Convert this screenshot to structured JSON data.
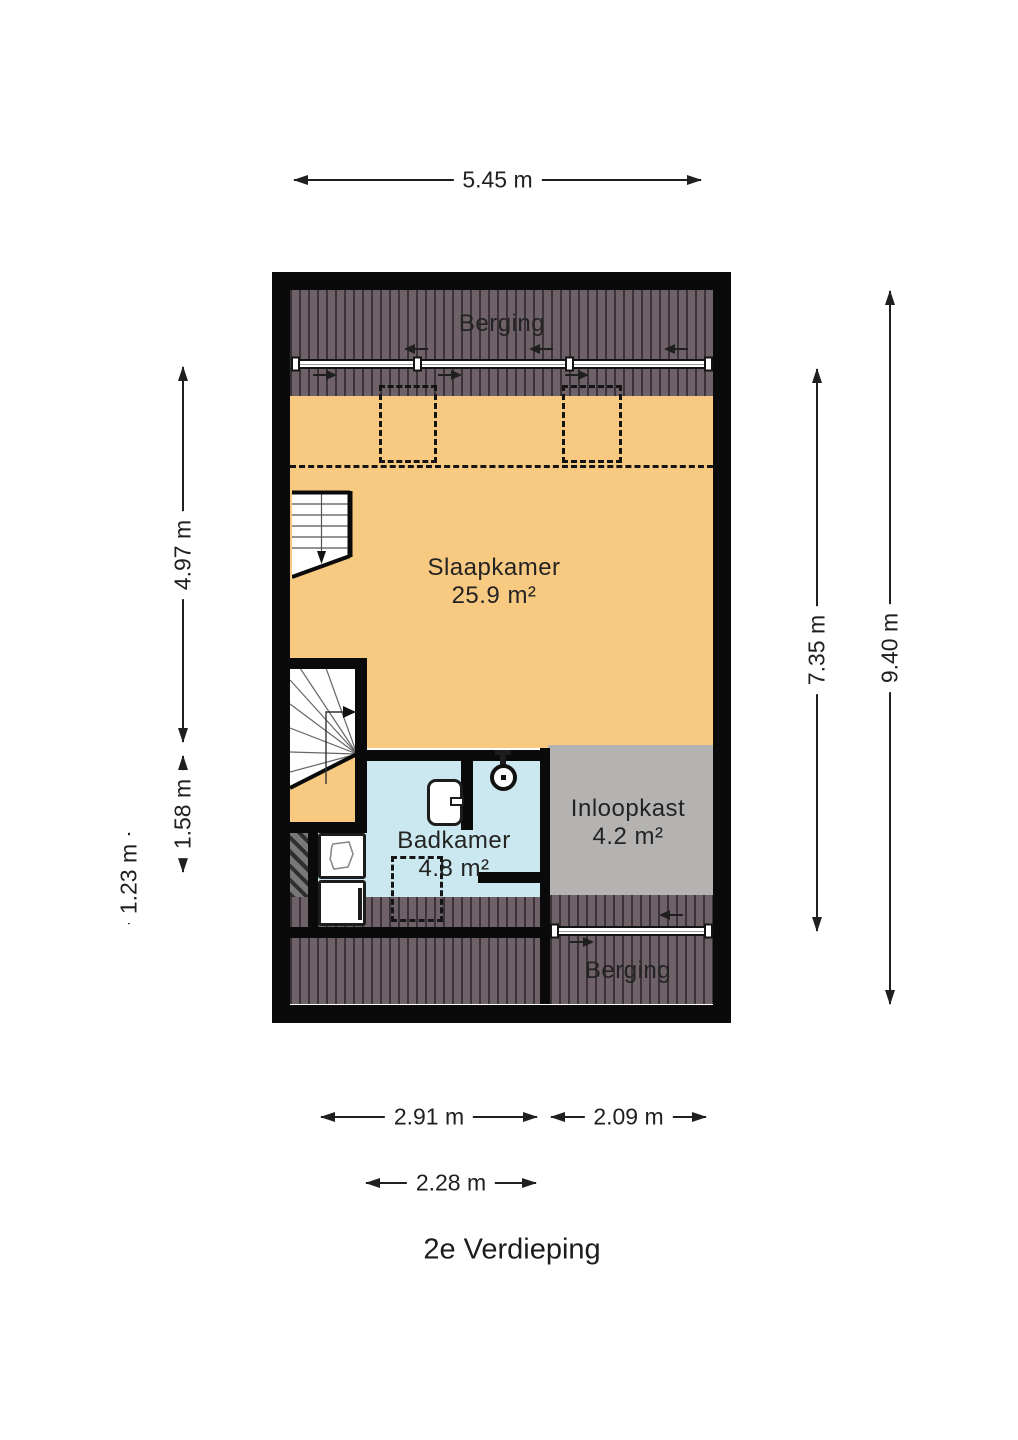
{
  "title": "2e Verdieping",
  "rooms": {
    "berging_top": {
      "label": "Berging"
    },
    "slaapkamer": {
      "label": "Slaapkamer",
      "area": "25.9 m²"
    },
    "badkamer": {
      "label": "Badkamer",
      "area": "4.8 m²"
    },
    "inloopkast": {
      "label": "Inloopkast",
      "area": "4.2 m²"
    },
    "berging_bottom": {
      "label": "Berging"
    }
  },
  "dimensions": {
    "top_width": "5.45 m",
    "left_upper": "4.97 m",
    "left_middle": "1.58 m",
    "left_lower": "1.23 m",
    "right_inner": "7.35 m",
    "right_total": "9.40 m",
    "bottom_left": "2.91 m",
    "bottom_right": "2.09 m",
    "bottom_bath": "2.28 m"
  },
  "colors": {
    "floor": "#f7c981",
    "bathroom": "#cbe7ef",
    "closet": "#b5b3b1",
    "storage_base": "#6f6168",
    "storage_stripe": "#3b3339",
    "wall": "#0a0a0a"
  },
  "icons": {
    "stairs_down": "stairs-down-icon",
    "stairs_up": "stairs-up-icon",
    "shower": "shower-head-icon",
    "sink": "sink-icon",
    "washer": "washer-icon",
    "basket": "laundry-basket-icon",
    "sliding_door": "sliding-door",
    "roof_window": "roof-window-dashed"
  }
}
